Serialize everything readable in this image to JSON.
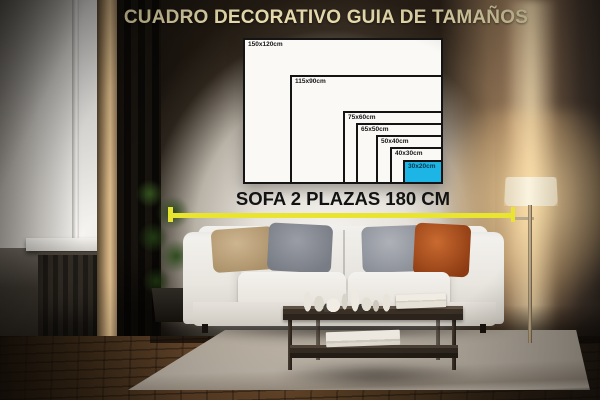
{
  "title": {
    "text": "CUADRO DECORATIVO GUIA DE TAMAÑOS",
    "color": "#e9ddae"
  },
  "size_guide": {
    "unit": "cm",
    "border_color": "#141414",
    "label_color": "#161616",
    "highlight_color": "#1db4e6",
    "highlight_label_color": "#0b3745",
    "sizes": [
      {
        "label": "150x120cm",
        "width_cm": 150,
        "height_cm": 120,
        "highlighted": false
      },
      {
        "label": "115x90cm",
        "width_cm": 115,
        "height_cm": 90,
        "highlighted": false
      },
      {
        "label": "75x60cm",
        "width_cm": 75,
        "height_cm": 60,
        "highlighted": false
      },
      {
        "label": "65x50cm",
        "width_cm": 65,
        "height_cm": 50,
        "highlighted": false
      },
      {
        "label": "50x40cm",
        "width_cm": 50,
        "height_cm": 40,
        "highlighted": false
      },
      {
        "label": "40x30cm",
        "width_cm": 40,
        "height_cm": 30,
        "highlighted": false
      },
      {
        "label": "30x20cm",
        "width_cm": 30,
        "height_cm": 20,
        "highlighted": true
      }
    ]
  },
  "measurement": {
    "label": "SOFA 2 PLAZAS 180 CM",
    "label_color": "#121212",
    "line_color": "#e9e42f",
    "sofa_width_cm": 180
  }
}
